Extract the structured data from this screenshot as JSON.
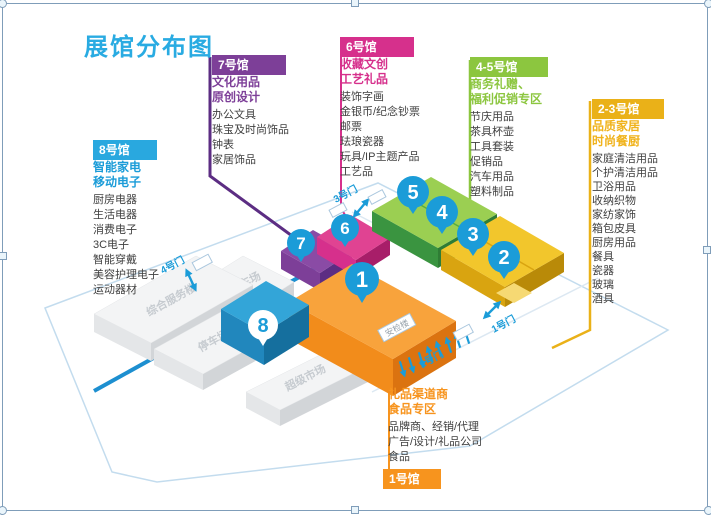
{
  "title": "展馆分布图",
  "colors": {
    "title_cyan": "#29abe2",
    "purple": "#7d3f98",
    "magenta": "#d6308c",
    "green": "#8cc63f",
    "amber": "#eab118",
    "blue": "#29a8df",
    "orange": "#f7941e",
    "pin_blue": "#1b9cd8"
  },
  "cards": {
    "hall7": {
      "header": "7号馆",
      "subtitle1": "文化用品",
      "subtitle2": "原创设计",
      "items": [
        "办公文具",
        "珠宝及时尚饰品",
        "钟表",
        "家居饰品"
      ]
    },
    "hall6": {
      "header": "6号馆",
      "subtitle1": "收藏文创",
      "subtitle2": "工艺礼品",
      "items": [
        "装饰字画",
        "金银币/纪念钞票",
        "邮票",
        "珐琅瓷器",
        "玩具/IP主题产品",
        "工艺品"
      ]
    },
    "hall45": {
      "header": "4-5号馆",
      "subtitle1": "商务礼赠、",
      "subtitle2": "福利促销专区",
      "items": [
        "节庆用品",
        "茶具杯壶",
        "工具套装",
        "促销品",
        "汽车用品",
        "塑料制品"
      ]
    },
    "hall23": {
      "header": "2-3号馆",
      "subtitle1": "品质家居",
      "subtitle2": "时尚餐厨",
      "items": [
        "家庭清洁用品",
        "个护清洁用品",
        "卫浴用品",
        "收纳织物",
        "家纺家饰",
        "箱包皮具",
        "厨房用品",
        "餐具",
        "瓷器",
        "玻璃",
        "酒具"
      ]
    },
    "hall8": {
      "header": "8号馆",
      "subtitle1": "智能家电",
      "subtitle2": "移动电子",
      "items": [
        "厨房电器",
        "生活电器",
        "消费电子",
        "3C电子",
        "智能穿戴",
        "美容护理电子",
        "运动器材"
      ]
    },
    "hall1": {
      "header": "1号馆",
      "subtitle1": "礼品渠道商",
      "subtitle2": "食品专区",
      "items": [
        "品牌商、经销/代理",
        "广告/设计/礼品公司",
        "食品"
      ]
    }
  },
  "map": {
    "buildings": {
      "parking_north": "停车场",
      "service_center": "综合服务楼",
      "parking_south": "停车场",
      "supermarket": "超级市场",
      "security": "安检楼"
    },
    "gates": {
      "gate4": "4号门",
      "gate3": "3号门",
      "gate2": "2号门",
      "gate1": "1号门"
    },
    "pins": {
      "p1": "1",
      "p2": "2",
      "p3": "3",
      "p4": "4",
      "p5": "5",
      "p6": "6",
      "p7": "7",
      "p8": "8"
    }
  }
}
